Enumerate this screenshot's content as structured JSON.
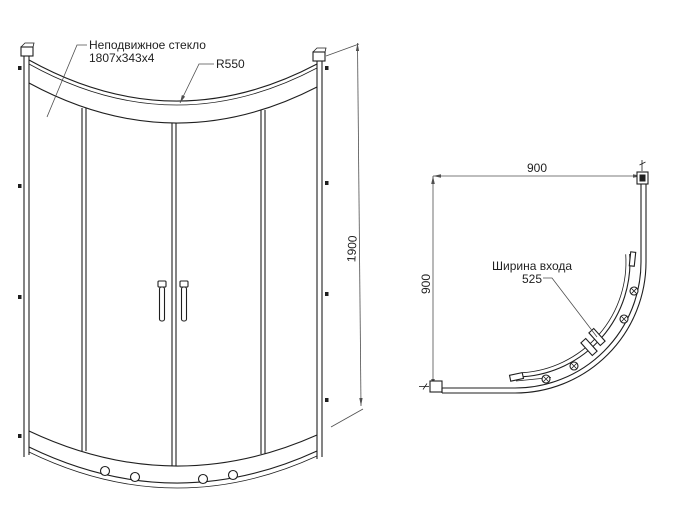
{
  "colors": {
    "bg": "#ffffff",
    "line": "#1f1f1f",
    "dimension": "#4f4f4f",
    "text": "#1f1f1f"
  },
  "front_view": {
    "label_fixed_glass_line1": "Неподвижное стекло",
    "label_fixed_glass_line2": "1807x343x4",
    "label_radius": "R550",
    "dim_height": "1900"
  },
  "plan_view": {
    "dim_width": "900",
    "dim_depth": "900",
    "label_entry_line1": "Ширина входа",
    "label_entry_line2": "525"
  }
}
